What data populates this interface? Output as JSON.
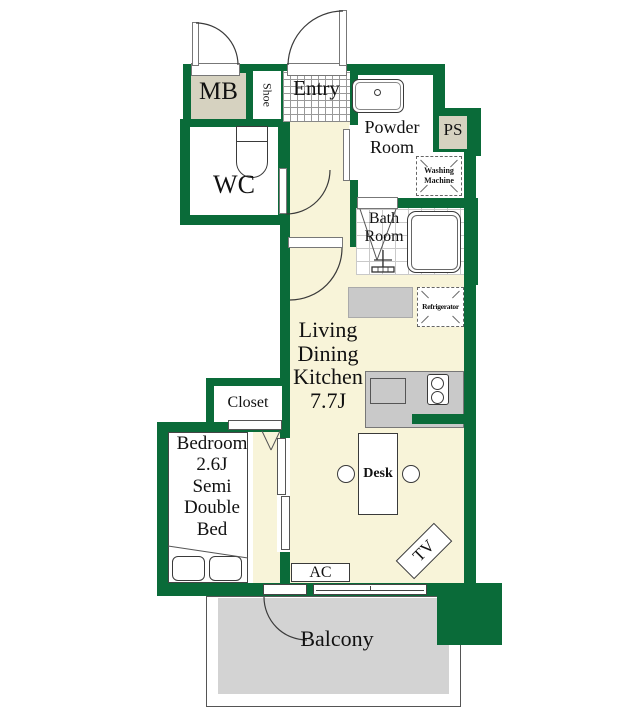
{
  "plan": {
    "labels": {
      "mb": "MB",
      "shoe": "Shoe",
      "entry": "Entry",
      "wc": "WC",
      "powder_room": "Powder\nRoom",
      "ps": "PS",
      "washing_machine": "Washing\nMachine",
      "bath_room": "Bath\nRoom",
      "refrigerator": "Refrigerator",
      "ldk": "Living\nDining\nKitchen\n7.7J",
      "closet": "Closet",
      "bedroom": "Bedroom\n2.6J\nSemi\nDouble\nBed",
      "desk": "Desk",
      "ac": "AC",
      "tv": "TV",
      "balcony": "Balcony"
    },
    "colors": {
      "wall_green": "#0a6b39",
      "floor_cream": "#f8f4d9",
      "box_beige": "#d6d2c0",
      "balcony_gray": "#d3d3d3",
      "counter_gray": "#c9c9c9",
      "outline": "#3a3a3a"
    }
  }
}
